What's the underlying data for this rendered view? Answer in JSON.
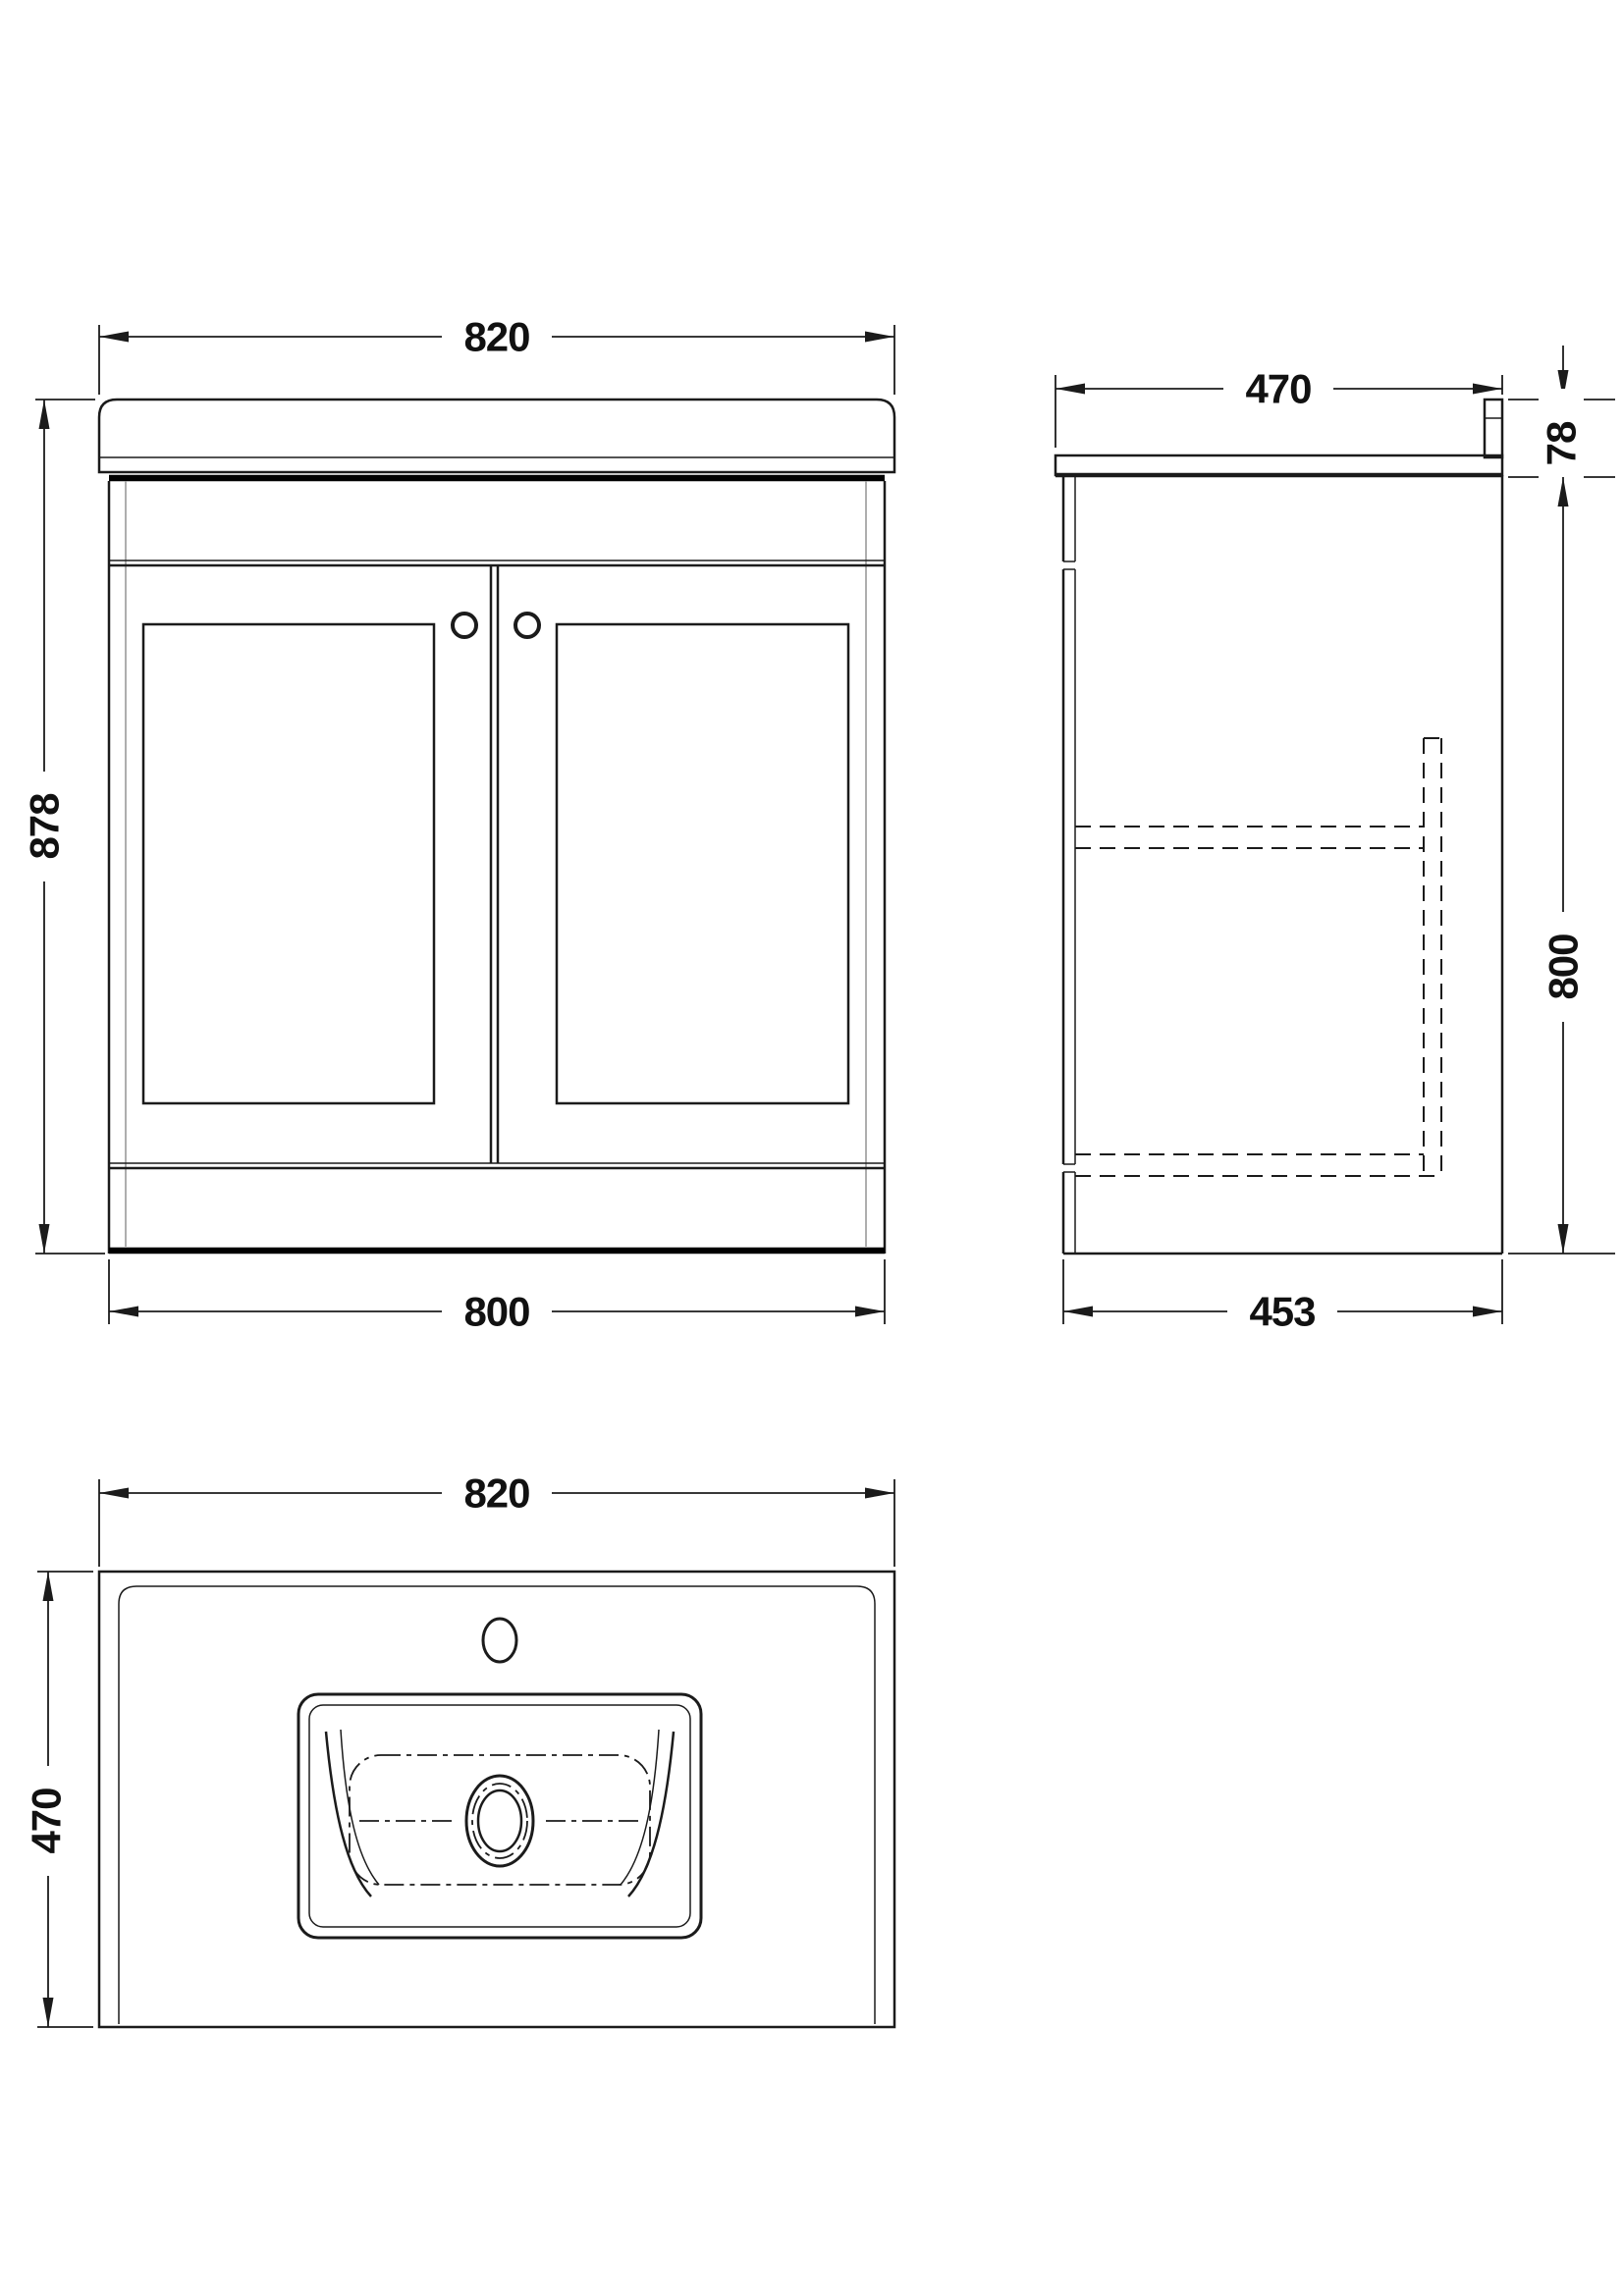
{
  "colors": {
    "background": "#ffffff",
    "line": "#1b1b1b",
    "light_line": "#9a9a9a",
    "label": "#111111"
  },
  "dimensions": {
    "front_top_width": "820",
    "front_height": "878",
    "front_bottom_width": "800",
    "side_top_depth": "470",
    "side_worktop_height": "78",
    "side_cabinet_height": "800",
    "side_bottom_depth": "453",
    "plan_width": "820",
    "plan_depth": "470"
  }
}
